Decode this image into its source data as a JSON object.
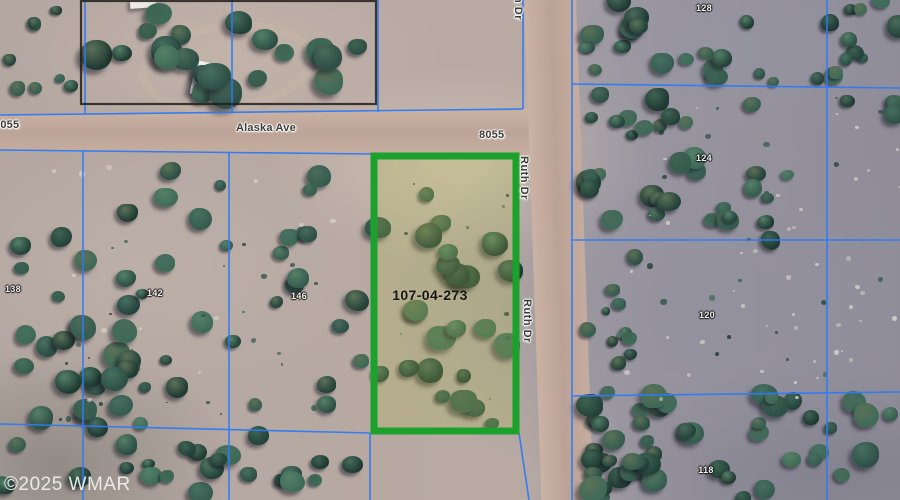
{
  "map": {
    "watermark": "©2025 WMAR",
    "apn_label": {
      "text": "107-04-273",
      "x": 430,
      "y": 295
    },
    "street_labels": [
      {
        "id": "street-label-8055-left",
        "text": "8055",
        "x": -6,
        "y": 119,
        "vertical": false
      },
      {
        "id": "street-label-alaska-ave",
        "text": "Alaska Ave",
        "x": 236,
        "y": 122,
        "vertical": false
      },
      {
        "id": "street-label-8055-mid",
        "text": "8055",
        "x": 479,
        "y": 129,
        "vertical": false
      },
      {
        "id": "street-label-ruth-dr-top",
        "text": "h Dr",
        "x": 512,
        "y": -4,
        "vertical": true
      },
      {
        "id": "street-label-ruth-dr-1",
        "text": "Ruth Dr",
        "x": 518,
        "y": 156,
        "vertical": true
      },
      {
        "id": "street-label-ruth-dr-2",
        "text": "Ruth Dr",
        "x": 521,
        "y": 299,
        "vertical": true
      }
    ],
    "parcel_labels": [
      {
        "id": "parcel-label-128",
        "text": "128",
        "x": 704,
        "y": 8
      },
      {
        "id": "parcel-label-124",
        "text": "124",
        "x": 704,
        "y": 158
      },
      {
        "id": "parcel-label-120",
        "text": "120",
        "x": 707,
        "y": 315
      },
      {
        "id": "parcel-label-118",
        "text": "118",
        "x": 706,
        "y": 470
      },
      {
        "id": "parcel-label-138",
        "text": "138",
        "x": 13,
        "y": 289
      },
      {
        "id": "parcel-label-142",
        "text": "142",
        "x": 155,
        "y": 293
      },
      {
        "id": "parcel-label-146",
        "text": "146",
        "x": 299,
        "y": 296
      }
    ],
    "colors": {
      "parcel_highlight_green": "#1ca22c",
      "parcel_highlight_fill": "rgba(176,188,70,0.24)",
      "boundary_blue": "#2d7bf5",
      "fence_black": "#221f1b"
    }
  }
}
